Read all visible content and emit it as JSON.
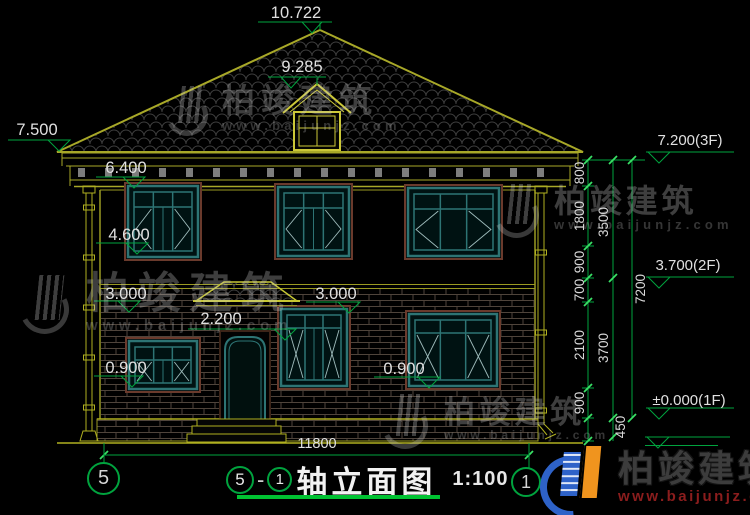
{
  "drawing": {
    "dims_top": {
      "ridge": "10.722",
      "dormer": "9.285"
    },
    "levels_left": {
      "eave": "7.500",
      "cornice": "6.400",
      "sill_2f": "4.600",
      "band": "3.000",
      "canopy": "2.200",
      "sill_1f": "0.900"
    },
    "dims_mid": {
      "lintel": "3.000",
      "sill": "0.900"
    },
    "levels_right": {
      "f3": "7.200(3F)",
      "f2": "3.700(2F)",
      "f1": "±0.000(1F)"
    },
    "chain": {
      "segments": [
        "800",
        "1800",
        "900",
        "700",
        "2100",
        "900"
      ],
      "subtotals": [
        "3500",
        "3700"
      ],
      "total": "7200",
      "ground": "450"
    },
    "width_total": "11800",
    "grid": {
      "left": "5",
      "right": "1"
    }
  },
  "titlebar": {
    "axis_from": "5",
    "axis_sep": "-",
    "axis_to": "1",
    "title": "轴立面图",
    "scale": "1:100"
  },
  "watermark": {
    "brand": "柏竣建筑",
    "url": "www.baijunjz.com"
  },
  "logo": {
    "brand": "柏竣建筑",
    "url": "www.baijunjz.com"
  }
}
